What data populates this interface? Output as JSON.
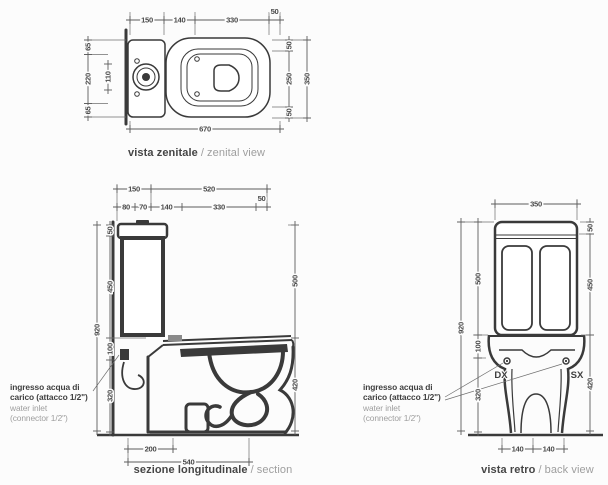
{
  "sep": "/",
  "zenital": {
    "caption_it": "vista zenitale",
    "caption_en": "zenital view",
    "top_dims": [
      "150",
      "140",
      "330",
      "50"
    ],
    "bottom_dim": "670",
    "left_dims": [
      "65",
      "220",
      "65"
    ],
    "left_inner_dim": "110",
    "right_dims": [
      "50",
      "250",
      "50"
    ],
    "right_total": "350"
  },
  "section": {
    "caption_it": "sezione longitudinale",
    "caption_en": "section",
    "row1_dims": [
      "150",
      "520"
    ],
    "row2_dims": [
      "80",
      "70",
      "140",
      "330",
      "50"
    ],
    "left_total": "920",
    "left_dims": [
      "50",
      "450",
      "100",
      "320"
    ],
    "right_dims": [
      "500",
      "420"
    ],
    "bottom_dims": [
      "200",
      "540"
    ]
  },
  "retro": {
    "caption_it": "vista retro",
    "caption_en": "back view",
    "top_dim": "350",
    "left_total": "920",
    "left_dims": [
      "500",
      "100",
      "320"
    ],
    "right_dims": [
      "50",
      "450",
      "420"
    ],
    "bottom_dims": [
      "140",
      "140"
    ],
    "side_labels": [
      "DX",
      "SX"
    ]
  },
  "inlet_label": {
    "it_line1": "ingresso acqua di",
    "it_line2": "carico (attacco 1/2\")",
    "en_line1": "water inlet",
    "en_line2": "(connector 1/2\")"
  },
  "colors": {
    "line": "#3a3a3a",
    "dim": "#4a4a4a",
    "caption_it": "#454545",
    "caption_en": "#9e9e9e"
  }
}
